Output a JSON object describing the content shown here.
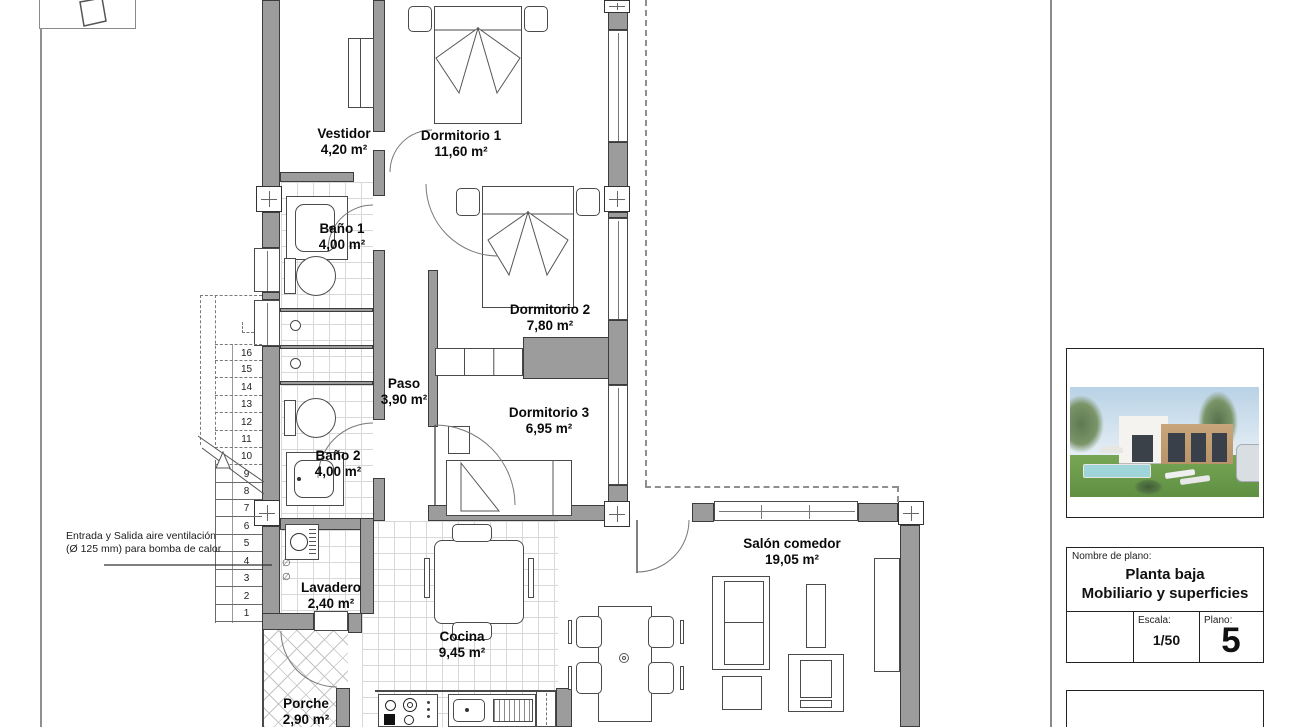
{
  "plan": {
    "rooms": [
      {
        "name": "Vestidor",
        "area": "4,20 m²"
      },
      {
        "name": "Dormitorio 1",
        "area": "11,60 m²"
      },
      {
        "name": "Baño 1",
        "area": "4,00 m²"
      },
      {
        "name": "Dormitorio 2",
        "area": "7,80 m²"
      },
      {
        "name": "Paso",
        "area": "3,90 m²"
      },
      {
        "name": "Dormitorio 3",
        "area": "6,95 m²"
      },
      {
        "name": "Baño 2",
        "area": "4,00 m²"
      },
      {
        "name": "Lavadero",
        "area": "2,40 m²"
      },
      {
        "name": "Cocina",
        "area": "9,45 m²"
      },
      {
        "name": "Porche",
        "area": "2,90 m²"
      },
      {
        "name": "Salón comedor",
        "area": "19,05 m²"
      }
    ],
    "stairs": {
      "steps": [
        "16",
        "15",
        "14",
        "13",
        "12",
        "11",
        "10",
        "9",
        "8",
        "7",
        "6",
        "5",
        "4",
        "3",
        "2",
        "1"
      ]
    },
    "annotation": {
      "line1": "Entrada y Salida aire ventilación",
      "line2": "(Ø 125 mm) para bomba de calor"
    },
    "lavadero": {
      "symbols": [
        "∅",
        "∅"
      ]
    }
  },
  "title_block": {
    "name_label": "Nombre de plano:",
    "title_line1": "Planta baja",
    "title_line2": "Mobiliario y superficies",
    "escala_label": "Escala:",
    "escala_value": "1/50",
    "plano_label": "Plano:",
    "plano_value": "5"
  },
  "colors": {
    "wall": "#9c9c9c",
    "line": "#3c3c3c",
    "tile": "#d8d8d8",
    "sky": "#b9d2e6",
    "grass": "#77a654",
    "pool": "#9fd4d8",
    "tan": "#c8a57a"
  }
}
